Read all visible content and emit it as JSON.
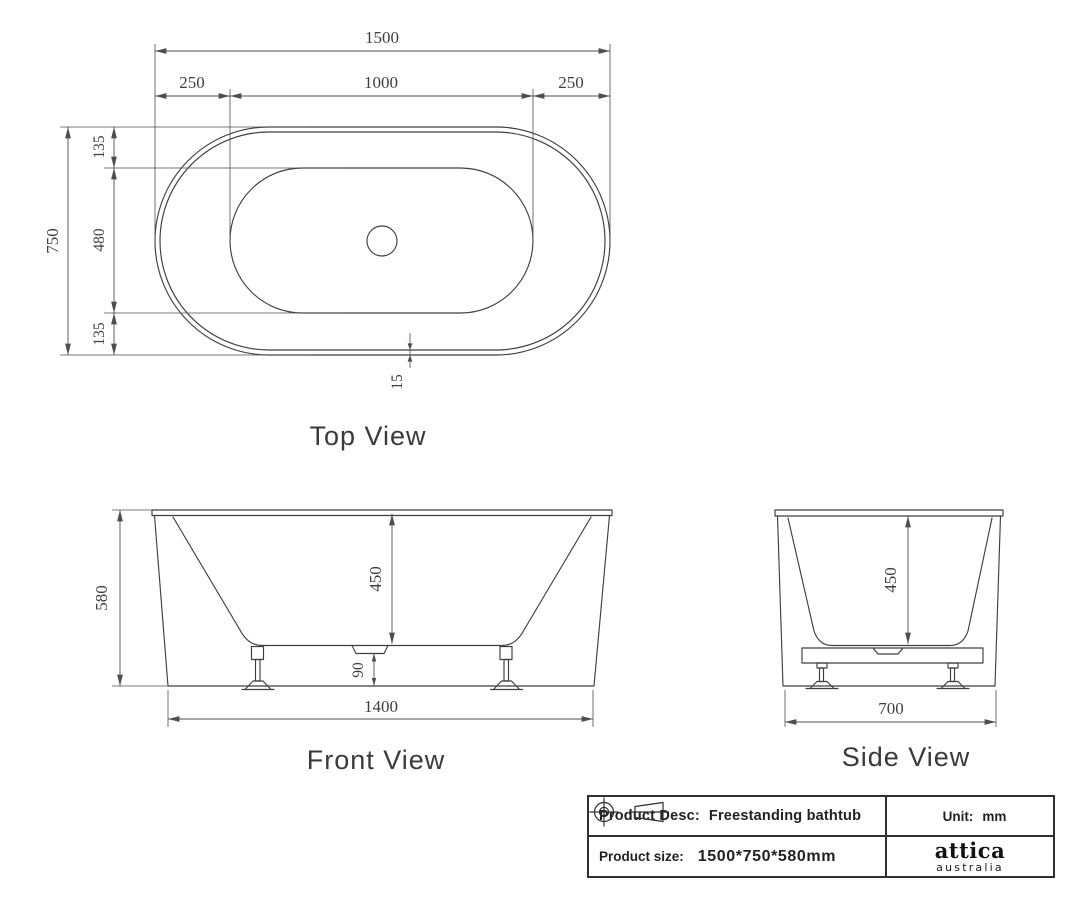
{
  "drawing": {
    "product": "Freestanding bathtub",
    "unit": "mm",
    "colors": {
      "line": "#3f3f3f",
      "dimension": "#4e4e4e",
      "text": "#3a3a3a",
      "title_border": "#2f2f2f"
    }
  },
  "top_view": {
    "label": "Top View",
    "dims": {
      "overall_length": "1500",
      "left_offset": "250",
      "inner_length": "1000",
      "right_offset": "250",
      "overall_width": "750",
      "top_margin": "135",
      "inner_width": "480",
      "bottom_margin": "135",
      "rim_thickness": "15"
    }
  },
  "front_view": {
    "label": "Front View",
    "dims": {
      "overall_height": "580",
      "inner_depth": "450",
      "drain_height": "90",
      "base_length": "1400"
    }
  },
  "side_view": {
    "label": "Side View",
    "dims": {
      "inner_depth": "450",
      "base_width": "700"
    }
  },
  "title_block": {
    "product_desc_label": "Product Desc:",
    "product_desc_value": "Freestanding bathtub",
    "product_size_label": "Product size:",
    "product_size_value": "1500*750*580mm",
    "unit_label": "Unit:",
    "unit_value": "mm",
    "brand_name": "attica",
    "brand_sub": "australia"
  },
  "icons": {
    "projection_target": "first-angle-projection-target-icon",
    "projection_cone": "first-angle-projection-cone-icon"
  }
}
